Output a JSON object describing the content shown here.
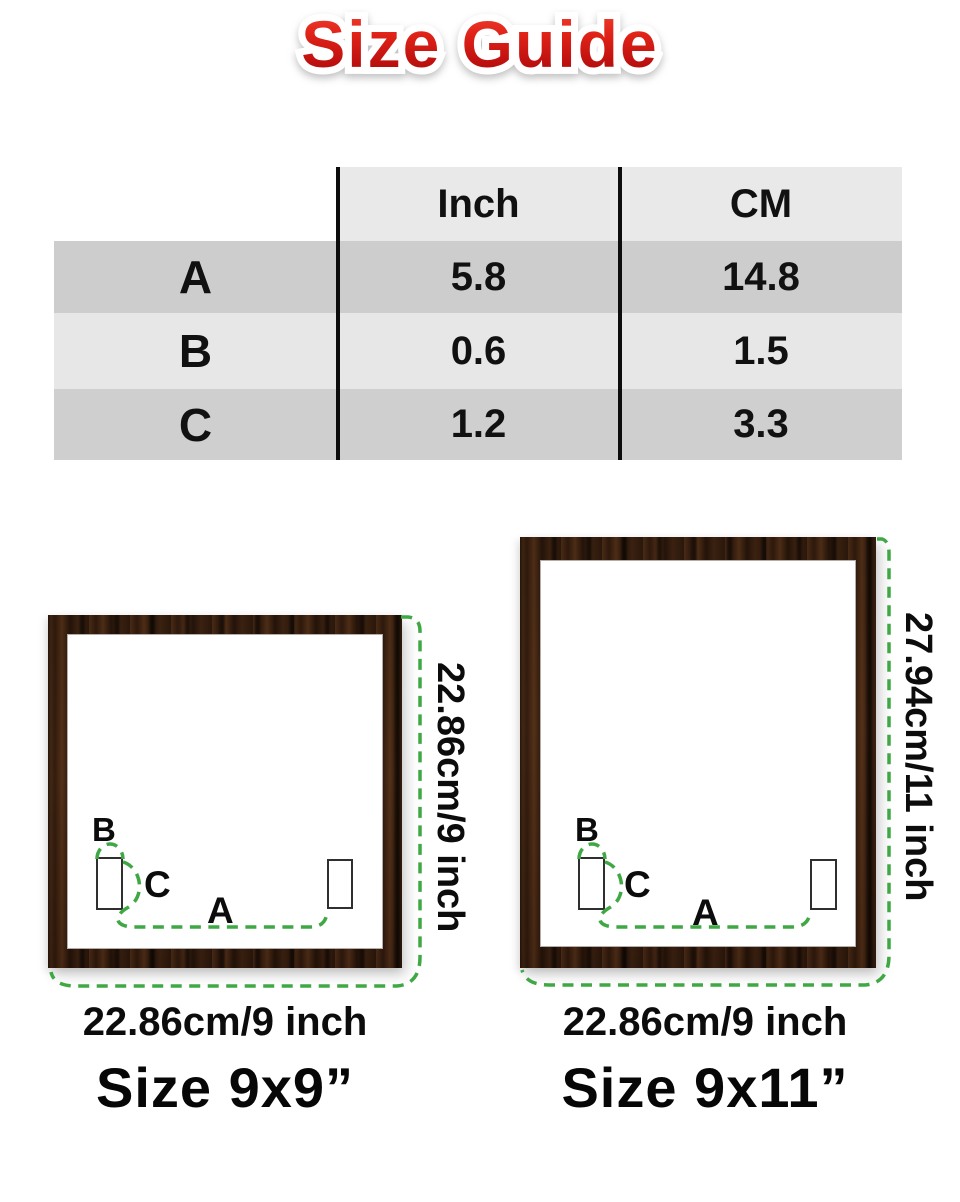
{
  "page": {
    "title": "Size Guide"
  },
  "size_table": {
    "col_headers": {
      "label": "",
      "inch": "Inch",
      "cm": "CM"
    },
    "rows": [
      {
        "label": "A",
        "inch": "5.8",
        "cm": "14.8"
      },
      {
        "label": "B",
        "inch": "0.6",
        "cm": "1.5"
      },
      {
        "label": "C",
        "inch": "1.2",
        "cm": "3.3"
      }
    ]
  },
  "frames": {
    "left": {
      "height_label": "22.86cm/9 inch",
      "width_label": "22.86cm/9 inch",
      "size_label": "Size 9x9”",
      "marker_a": "A",
      "marker_b": "B",
      "marker_c": "C"
    },
    "right": {
      "height_label": "27.94cm/11 inch",
      "width_label": "22.86cm/9 inch",
      "size_label": "Size 9x11”",
      "marker_a": "A",
      "marker_b": "B",
      "marker_c": "C"
    }
  },
  "colors": {
    "dimension_green": "#3fa844",
    "title_red_top": "#f4473a",
    "title_red_bottom": "#9e0a07",
    "table_row_dark": "#cdcdcd",
    "table_row_light": "#e7e7e7",
    "table_header_gray": "#e9e9e9",
    "wood_brown": "#331d10"
  }
}
